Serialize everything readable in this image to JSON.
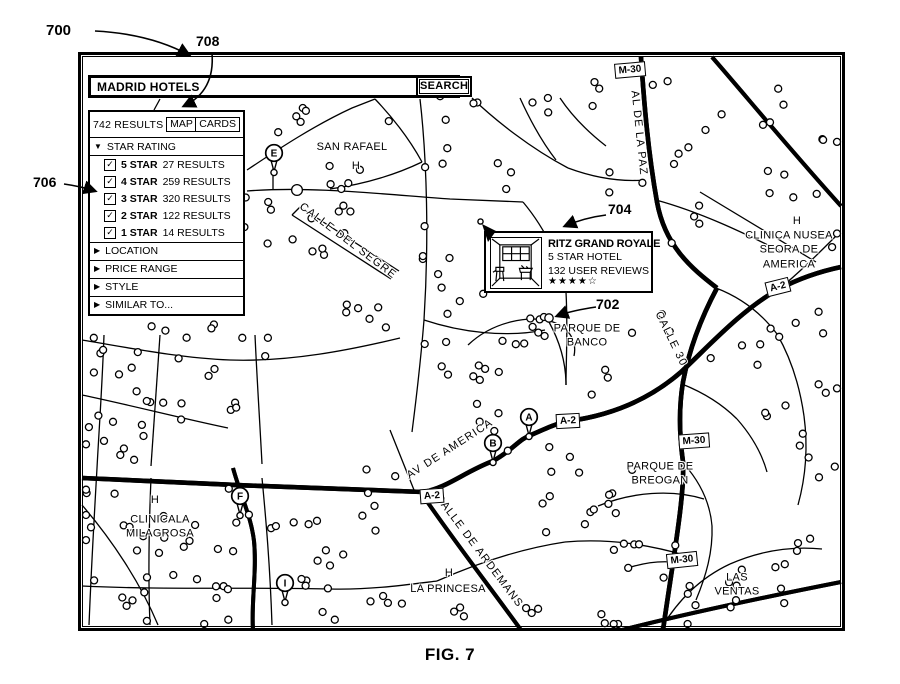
{
  "figure": {
    "caption": "FIG. 7",
    "refs": {
      "fig": "700",
      "marker": "702",
      "callout": "704",
      "panel": "706",
      "tabs": "708"
    }
  },
  "colors": {
    "ink": "#000000",
    "paper": "#ffffff"
  },
  "search_bar": {
    "query": "MADRID HOTELS",
    "button_label": "SEARCH"
  },
  "results_panel": {
    "count_label": "742 RESULTS",
    "tabs": [
      {
        "label": "MAP",
        "active": true
      },
      {
        "label": "CARDS",
        "active": false
      }
    ],
    "expand_icon": "▼",
    "collapse_icon": "▶",
    "check_icon": "✓",
    "sections": [
      {
        "label": "STAR RATING",
        "expanded": true,
        "items": [
          {
            "checked": true,
            "label": "5 STAR",
            "count": "27 RESULTS"
          },
          {
            "checked": true,
            "label": "4 STAR",
            "count": "259 RESULTS"
          },
          {
            "checked": true,
            "label": "3 STAR",
            "count": "320 RESULTS"
          },
          {
            "checked": true,
            "label": "2 STAR",
            "count": "122 RESULTS"
          },
          {
            "checked": true,
            "label": "1 STAR",
            "count": "14 RESULTS"
          }
        ]
      },
      {
        "label": "LOCATION",
        "expanded": false,
        "items": []
      },
      {
        "label": "PRICE RANGE",
        "expanded": false,
        "items": []
      },
      {
        "label": "STYLE",
        "expanded": false,
        "items": []
      },
      {
        "label": "SIMILAR TO...",
        "expanded": false,
        "items": []
      }
    ]
  },
  "hotel_callout": {
    "title": "RITZ GRAND ROYALE",
    "subtitle": "5 STAR HOTEL",
    "reviews": "132 USER REVIEWS",
    "stars": "★★★★☆",
    "rating_filled": 4,
    "rating_outline": 1
  },
  "map": {
    "place_labels": [
      {
        "text": "SAN RAFAEL",
        "x": 352,
        "y": 147
      },
      {
        "text": "H",
        "x": 356,
        "y": 166
      },
      {
        "text": "H",
        "x": 797,
        "y": 221
      },
      {
        "text": "CLINICA NUSEA\nSEORA DE AMERICA",
        "x": 789,
        "y": 250
      },
      {
        "text": "PARQUE DE\nBANCO",
        "x": 587,
        "y": 336
      },
      {
        "text": "PARQUE DE\nBREOGAN",
        "x": 660,
        "y": 474
      },
      {
        "text": "LAS\nVENTAS",
        "x": 737,
        "y": 585
      },
      {
        "text": "H",
        "x": 155,
        "y": 500
      },
      {
        "text": "CLINICALA\nMILAGROSA",
        "x": 160,
        "y": 527
      },
      {
        "text": "H",
        "x": 449,
        "y": 573
      },
      {
        "text": "LA PRINCESA",
        "x": 448,
        "y": 589
      }
    ],
    "street_labels": [
      {
        "text": "CALLE DEL SEGRE",
        "x": 348,
        "y": 241,
        "angle": 37
      },
      {
        "text": "AV DE AMERICA",
        "x": 450,
        "y": 449,
        "angle": -33
      },
      {
        "text": "CALLE DE ARDEMANS",
        "x": 479,
        "y": 551,
        "angle": 53
      },
      {
        "text": "CALLE 30",
        "x": 671,
        "y": 339,
        "angle": 64
      },
      {
        "text": "AL DE LA PAZ",
        "x": 639,
        "y": 133,
        "angle": 84
      }
    ],
    "road_badges": [
      {
        "label": "M-30",
        "x": 630,
        "y": 70,
        "angle": -5
      },
      {
        "label": "M-30",
        "x": 694,
        "y": 441,
        "angle": -4
      },
      {
        "label": "M-30",
        "x": 682,
        "y": 560,
        "angle": -6
      },
      {
        "label": "A-2",
        "x": 568,
        "y": 421,
        "angle": -3
      },
      {
        "label": "A-2",
        "x": 432,
        "y": 496,
        "angle": -4
      },
      {
        "label": "A-2",
        "x": 778,
        "y": 287,
        "angle": -14
      }
    ],
    "pins": [
      {
        "label": "E",
        "x": 274,
        "y": 153
      },
      {
        "label": "A",
        "x": 529,
        "y": 417
      },
      {
        "label": "B",
        "x": 493,
        "y": 443
      },
      {
        "label": "F",
        "x": 240,
        "y": 496
      },
      {
        "label": "I",
        "x": 285,
        "y": 583
      }
    ]
  }
}
